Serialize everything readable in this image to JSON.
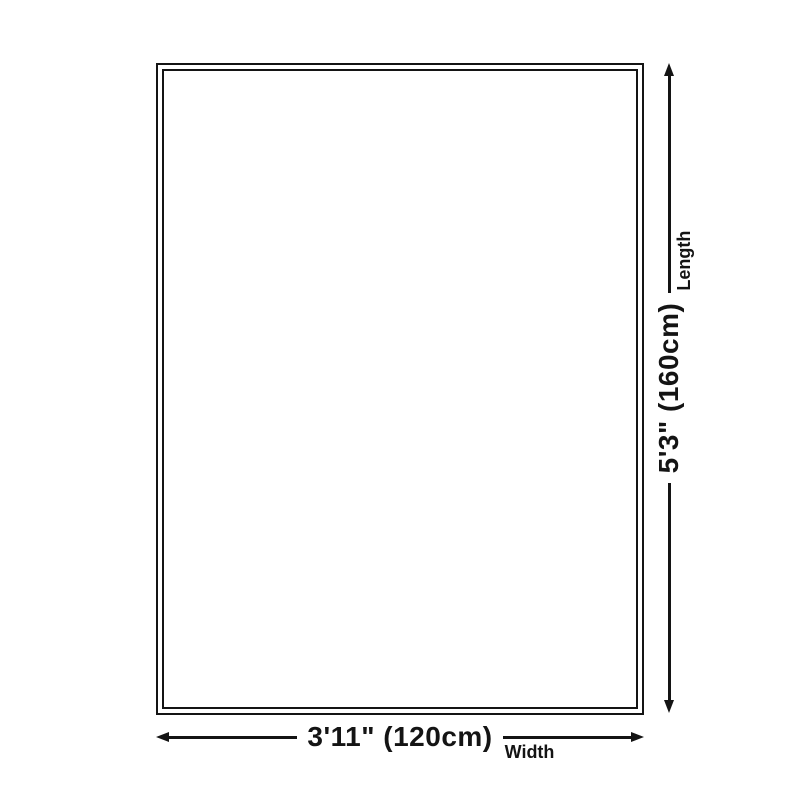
{
  "diagram": {
    "background_color": "#ffffff",
    "ink_color": "#141414",
    "dimensions": {
      "length": {
        "value": "5'3\" (160cm)",
        "label": "Length"
      },
      "width": {
        "value": "3'11\" (120cm)",
        "label": "Width"
      }
    },
    "icons": {
      "length_arrow": "double-headed-vertical-arrow",
      "width_arrow": "double-headed-horizontal-arrow"
    }
  }
}
